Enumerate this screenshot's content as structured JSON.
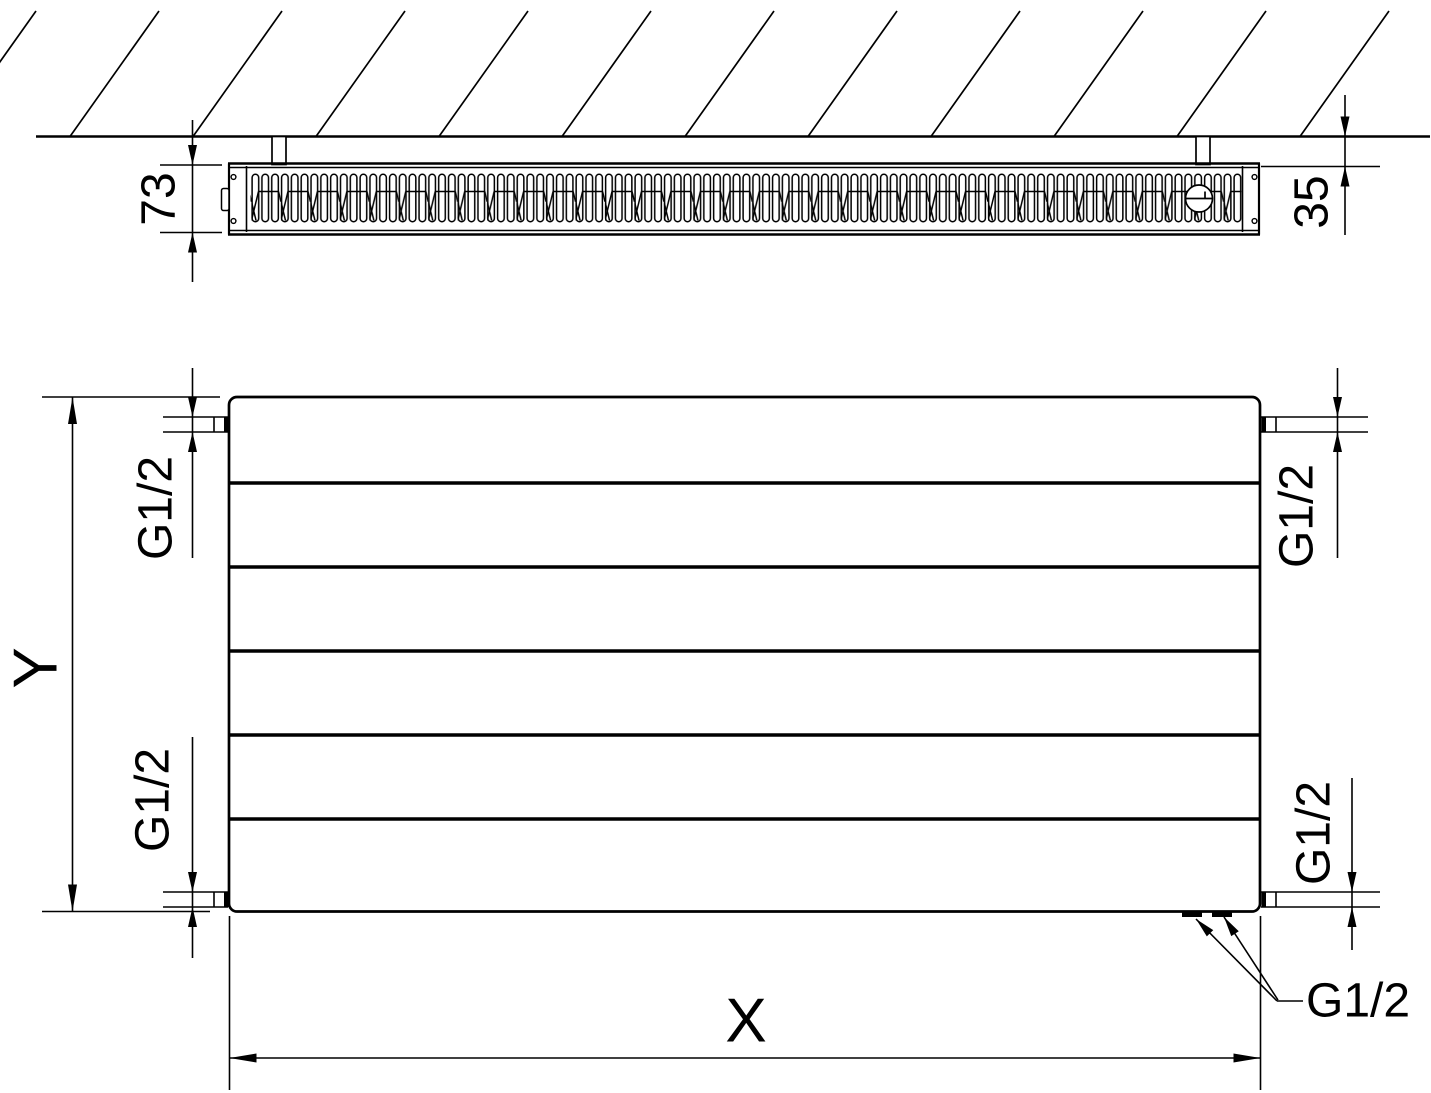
{
  "drawing": {
    "line_color": "#000000",
    "background_color": "#ffffff",
    "top_view": {
      "depth_label": "73",
      "wall_clearance_label": "35"
    },
    "front_view": {
      "height_label": "Y",
      "width_label": "X",
      "connection_top_left": "G1/2",
      "connection_top_right": "G1/2",
      "connection_bottom_left": "G1/2",
      "connection_bottom_right": "G1/2",
      "connection_bottom_outlets": "G1/2"
    }
  }
}
